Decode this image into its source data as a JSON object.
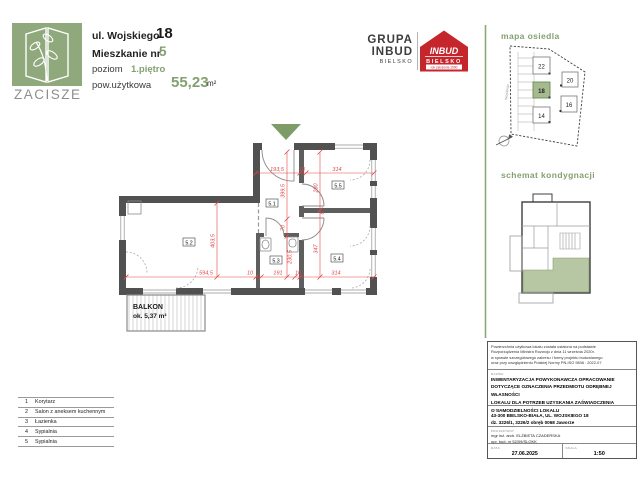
{
  "colors": {
    "brand_green": "#8fa87c",
    "dim_red": "#e04646",
    "logo_red": "#c5262c",
    "highlight_green": "#b7c6a3"
  },
  "header": {
    "brand": "ZACISZE",
    "street_label": "ul. Wojskiego",
    "street_number": "18",
    "apartment_label": "Mieszkanie nr",
    "apartment_number": "5",
    "level_label": "poziom",
    "level_value": "1.piętro",
    "area_label": "pow.użytkowa",
    "area_value": "55,23",
    "area_unit": "m²"
  },
  "logos": {
    "grupa_line1": "GRUPA",
    "grupa_line2": "INBUD",
    "grupa_line3": "BIELSKO",
    "inbud_name": "INBUD",
    "inbud_city": "BIELSKO",
    "inbud_tagline": "rok założenia 1990"
  },
  "sidebar": {
    "map": {
      "title": "mapa osiedla",
      "street_label": "Wojskiego",
      "buildings": {
        "b22": "22",
        "b20": "20",
        "b18": "18",
        "b16": "16",
        "b14": "14"
      },
      "highlighted": "18"
    },
    "schematic": {
      "title": "schemat kondygnacji"
    }
  },
  "plan": {
    "rooms": {
      "r51": "5.1",
      "r52": "5.2",
      "r53": "5.3",
      "r54": "5.4",
      "r55": "5.5"
    },
    "dims": {
      "top_a": "193,5",
      "top_b": "10",
      "top_c": "314",
      "bottom_a": "594,5",
      "bottom_b": "10",
      "bottom_c": "191",
      "bottom_d": "10",
      "bottom_e": "314",
      "v_corridor": "399,5",
      "v_small": "70",
      "v_bath": "230,5",
      "v_room55": "280",
      "v_room54": "347",
      "v_room52": "403,5",
      "v_door": "8"
    },
    "balcony": {
      "label": "BALKON",
      "area": "ok. 5,37 m²"
    }
  },
  "legend": {
    "rows": [
      {
        "num": "1",
        "name": "Korytarz"
      },
      {
        "num": "2",
        "name": "Salon z aneksem kuchennym"
      },
      {
        "num": "3",
        "name": "Łazienka"
      },
      {
        "num": "4",
        "name": "Sypialnia"
      },
      {
        "num": "5",
        "name": "Sypialnia"
      }
    ]
  },
  "titleblock": {
    "note_lines": [
      "Powierzchnia użytkowa lokalu została ustalona na podstawie",
      "Rozporządzenia Ministra Rozwoju z dnia 11 września 2020r.",
      "w sprawie szczegółowego zakresu i formy projektu budowlanego",
      "oraz przy uwzględnieniu Polskiej Normy PN-ISO 9836 : 2022-07"
    ],
    "name_label": "NAZWA",
    "name_lines": [
      "INWENTARYZACJA POWYKONAWCZA OPRACOWANIE",
      "DOTYCZĄCE OZNACZENIA PRZEDMIOTU ODRĘBNEJ WŁASNOŚCI",
      "LOKALU DLA POTRZEB UZYSKANIA ZAŚWIADCZENIA",
      "O SAMODZIELNOŚCI LOKALU"
    ],
    "address_label": "ADRES",
    "address_lines": [
      "43-300 BIELSKO-BIAŁA, UL. WOJSKIEGO 18",
      "dz. 3226/1, 3226/2 obręb 0068 Jaworze"
    ],
    "designer_label": "PROJEKTANT",
    "designer_lines": [
      "mgr inż. arch. ELŻBIETA CZADERSKA",
      "upr. bud. nr 52/09/SLOKK"
    ],
    "date_label": "DATA",
    "date_value": "27.06.2025",
    "scale_label": "SKALA",
    "scale_value": "1:50"
  }
}
